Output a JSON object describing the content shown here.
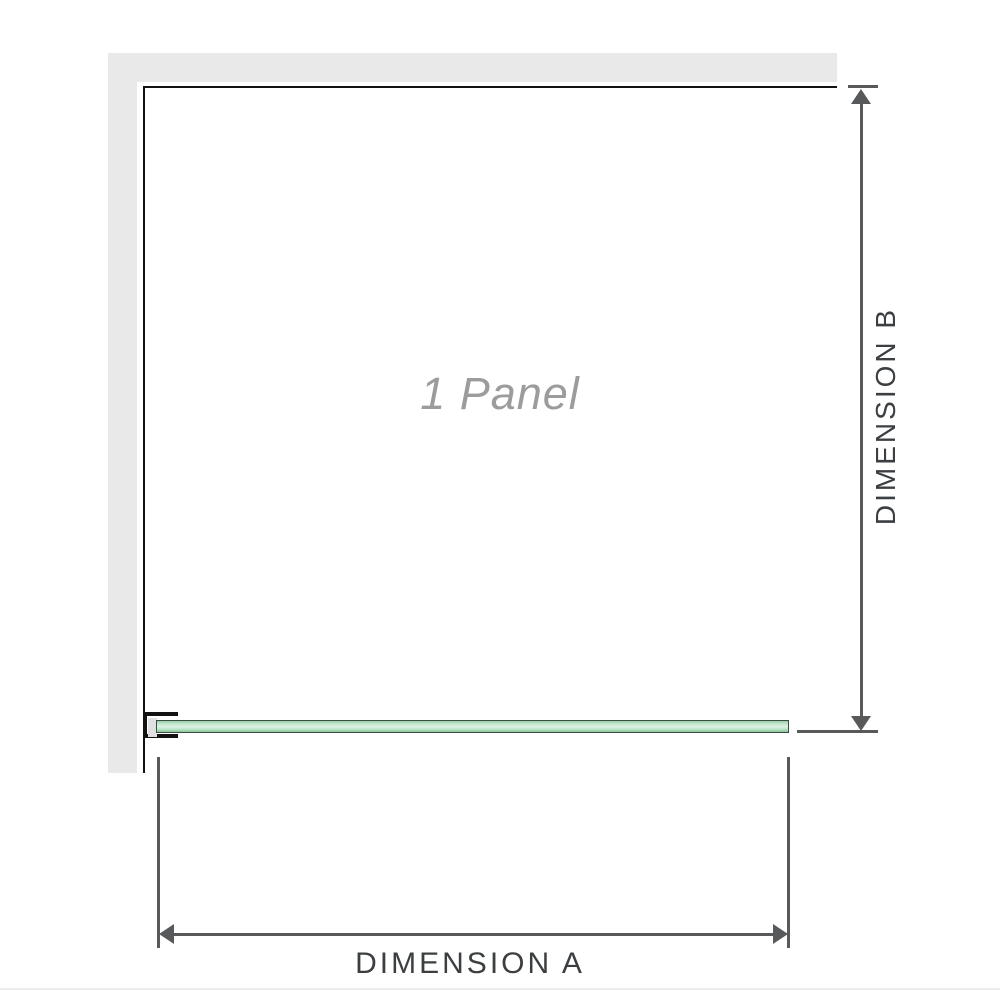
{
  "diagram": {
    "type": "shower-screen-installation-plan",
    "panel_label": "1 Panel",
    "dimension_a_label": "DIMENSION A",
    "dimension_b_label": "DIMENSION B"
  },
  "colors": {
    "wall_fill": "#e9e9e9",
    "panel_outline": "#121212",
    "dimension_line": "#58595b",
    "dimension_text": "#3c3f42",
    "watermark_text": "#9c9c9c",
    "glass_border": "#3f4a42",
    "glass_light": "#ddf1e4",
    "glass_dark": "#8fcfa5",
    "bracket_insert": "#e0e0e0",
    "baseline_rule": "#ececec"
  }
}
